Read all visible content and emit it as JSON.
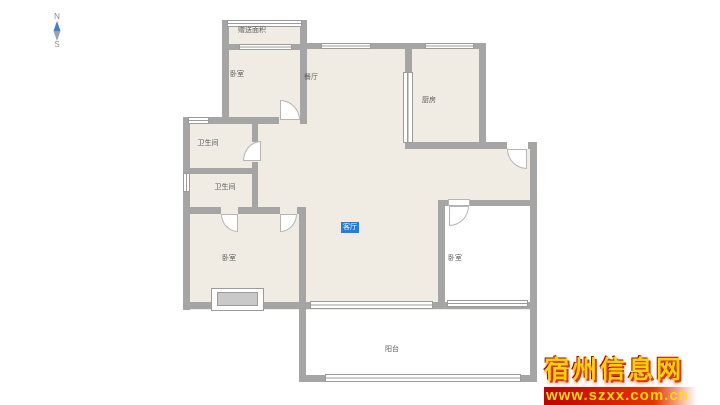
{
  "compass": {
    "north": "N",
    "south": "S"
  },
  "rooms": {
    "bonus_area": "赠送面积",
    "bedroom_top": "卧室",
    "dining": "餐厅",
    "kitchen": "厨房",
    "bathroom_upper": "卫生间",
    "bathroom_lower": "卫生间",
    "bedroom_left": "卧室",
    "living": "客厅",
    "bedroom_right": "卧室",
    "balcony": "阳台"
  },
  "watermark": {
    "site_name": "宿州信息网",
    "site_url": "www.szxx.com.cn"
  },
  "colors": {
    "wall": "#a5a5a5",
    "floor": "#f0ece3",
    "selected_label_bg": "#1e7fe0",
    "watermark_text": "#ffd200",
    "watermark_bar": "#c40000",
    "compass_needle_north": "#3b82d8",
    "compass_needle_south": "#9aa4ad"
  }
}
